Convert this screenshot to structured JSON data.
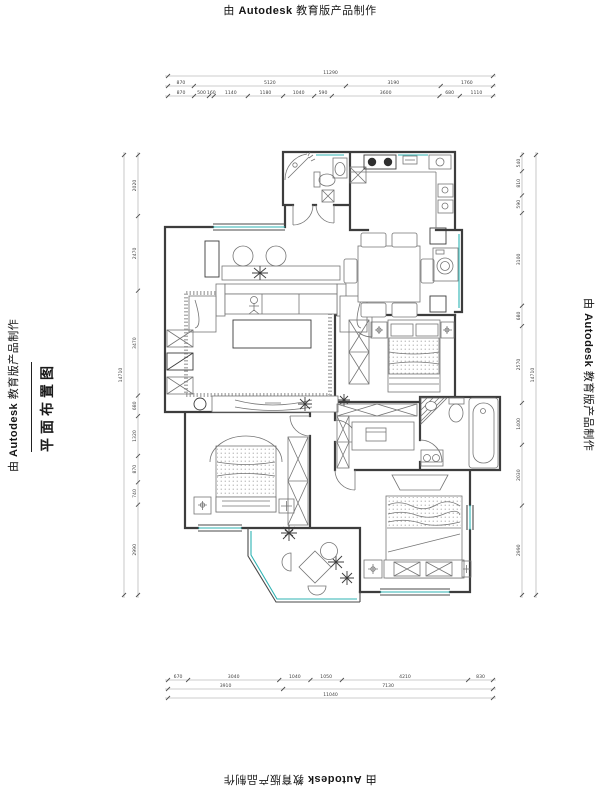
{
  "watermark": {
    "prefix": "由",
    "brand": "Autodesk",
    "suffix": "教育版产品制作"
  },
  "title": {
    "text": "平面布置图"
  },
  "colors": {
    "wall": "#3d3d3d",
    "furniture": "#757575",
    "window_accent": "#2fb3b3",
    "dimension_line": "#9a9a9a",
    "text": "#1a1a1a"
  },
  "dimensions": {
    "top": [
      [
        11290
      ],
      [
        870,
        5120,
        3190,
        1760
      ],
      [
        870,
        500,
        160,
        1140,
        1180,
        1040,
        590,
        3600,
        680,
        1110
      ]
    ],
    "bottom": [
      [
        670,
        3040,
        1040,
        1050,
        4210,
        830
      ],
      [
        3910,
        7130
      ],
      [
        11040
      ]
    ],
    "left": [
      [
        2020,
        2470,
        3470,
        680,
        1320,
        870,
        740,
        2990
      ],
      [
        14710
      ]
    ],
    "right": [
      [
        540,
        810,
        590,
        3100,
        680,
        2570,
        1400,
        2030,
        2990
      ],
      [
        14710
      ]
    ]
  },
  "plan_features": [
    "entry-door",
    "bathroom-shower-toilet-basin",
    "kitchen-cooktop-sink",
    "living-room-sofa-set",
    "coffee-table",
    "tv-console",
    "dining-table-six-chairs",
    "service-balcony-washing-machine",
    "bedroom-1-bed-wardrobe",
    "study-desk",
    "bathroom-2-bathtub-toilet",
    "master-bedroom-bed",
    "bedroom-2-bed-wardrobe",
    "leisure-balcony-tea-table",
    "plants"
  ]
}
